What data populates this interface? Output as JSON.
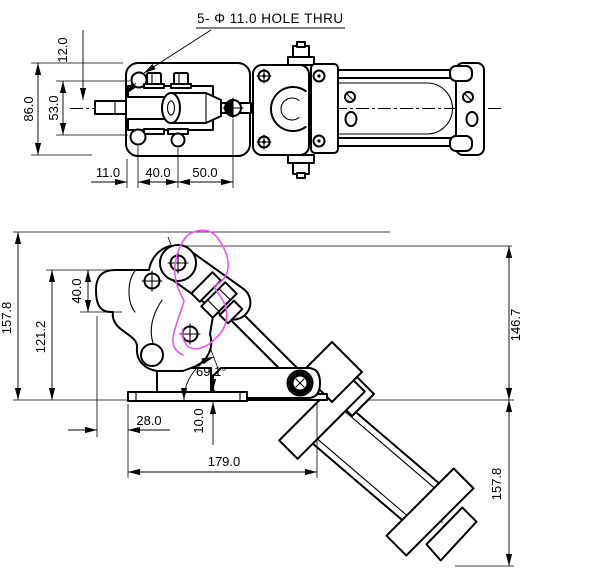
{
  "page": {
    "background": "#ffffff",
    "line_color": "#000000",
    "highlight_color": "#ee55ee"
  },
  "note": {
    "hole_callout": "5- Φ 11.0  HOLE THRU"
  },
  "top_view": {
    "dims": {
      "d12": "12.0",
      "d86": "86.0",
      "d53": "53.0",
      "d11": "11.0",
      "d40": "40.0",
      "d50": "50.0"
    }
  },
  "side_view": {
    "dims": {
      "d157_left": "157.8",
      "d121": "121.2",
      "d40": "40.0",
      "angle": "69.1°",
      "d28": "28.0",
      "d10": "10.0",
      "d179": "179.0",
      "d146": "146.7",
      "d157_right": "157.8"
    }
  }
}
